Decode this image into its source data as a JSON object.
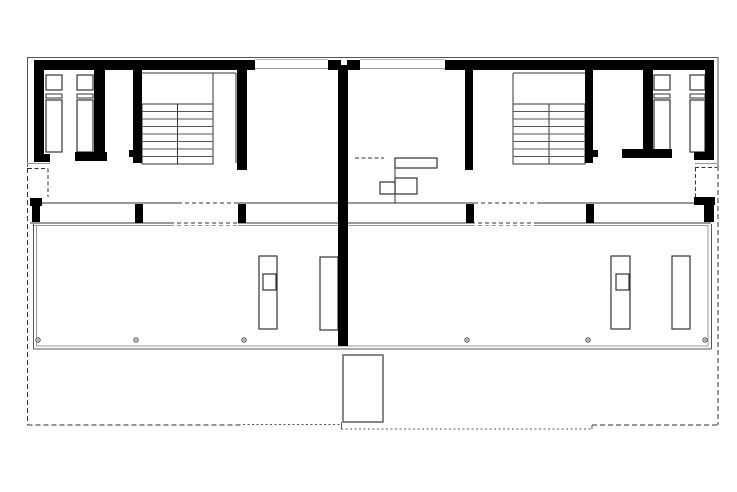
{
  "meta": {
    "viewbox": "0 0 737 492",
    "width": "737",
    "height": "492",
    "background": "#ffffff"
  },
  "colors": {
    "wall": "#000000",
    "dark": "#333333",
    "mid": "#555555",
    "soft": "#777777",
    "light": "#999999",
    "faint": "#bbbbbb",
    "white": "#ffffff"
  },
  "plan": {
    "walls": [
      {
        "x": 34,
        "y": 60,
        "w": 221,
        "h": 10,
        "name": "top-facade-left-segment"
      },
      {
        "x": 328,
        "y": 60,
        "w": 32,
        "h": 10,
        "name": "top-facade-center-pier"
      },
      {
        "x": 445,
        "y": 60,
        "w": 267,
        "h": 10,
        "name": "top-facade-right-segment"
      },
      {
        "x": 34,
        "y": 60,
        "w": 10,
        "h": 94,
        "name": "left-exterior-wall"
      },
      {
        "x": 34,
        "y": 154,
        "w": 16,
        "h": 8,
        "name": "left-exterior-wall-cap"
      },
      {
        "x": 94,
        "y": 68,
        "w": 11,
        "h": 84,
        "name": "left-bath-partition-wall"
      },
      {
        "x": 75,
        "y": 152,
        "w": 32,
        "h": 9,
        "name": "left-bath-partition-foot"
      },
      {
        "x": 133,
        "y": 68,
        "w": 9,
        "h": 95,
        "name": "left-stair-west-wall"
      },
      {
        "x": 129,
        "y": 150,
        "w": 5,
        "h": 7,
        "name": "left-stair-wall-stub"
      },
      {
        "x": 237,
        "y": 68,
        "w": 10,
        "h": 102,
        "name": "left-stair-east-wall"
      },
      {
        "x": 338,
        "y": 60,
        "w": 10,
        "h": 286,
        "name": "party-wall"
      },
      {
        "x": 465,
        "y": 68,
        "w": 8,
        "h": 102,
        "name": "right-stair-west-wall"
      },
      {
        "x": 585,
        "y": 68,
        "w": 8,
        "h": 95,
        "name": "right-stair-east-wall"
      },
      {
        "x": 593,
        "y": 150,
        "w": 5,
        "h": 7,
        "name": "right-stair-wall-stub"
      },
      {
        "x": 643,
        "y": 68,
        "w": 10,
        "h": 82,
        "name": "right-bath-partition-wall"
      },
      {
        "x": 622,
        "y": 149,
        "w": 50,
        "h": 9,
        "name": "right-bath-partition-foot"
      },
      {
        "x": 705,
        "y": 60,
        "w": 9,
        "h": 94,
        "name": "right-exterior-wall"
      },
      {
        "x": 694,
        "y": 152,
        "w": 20,
        "h": 8,
        "name": "right-exterior-wall-cap"
      },
      {
        "x": 30,
        "y": 198,
        "w": 12,
        "h": 8,
        "name": "left-entry-corner-cap"
      },
      {
        "x": 32,
        "y": 206,
        "w": 8,
        "h": 16,
        "name": "left-facade-pier"
      },
      {
        "x": 135,
        "y": 204,
        "w": 8,
        "h": 19,
        "name": "left-facade-mullion-1"
      },
      {
        "x": 238,
        "y": 204,
        "w": 8,
        "h": 19,
        "name": "left-facade-mullion-2"
      },
      {
        "x": 466,
        "y": 204,
        "w": 8,
        "h": 19,
        "name": "right-facade-mullion-1"
      },
      {
        "x": 586,
        "y": 204,
        "w": 8,
        "h": 19,
        "name": "right-facade-mullion-2"
      },
      {
        "x": 694,
        "y": 197,
        "w": 21,
        "h": 8,
        "name": "right-entry-corner-cap"
      },
      {
        "x": 704,
        "y": 205,
        "w": 10,
        "h": 17,
        "name": "right-facade-pier"
      }
    ],
    "white_rects": [
      {
        "x": 341,
        "y": 60,
        "w": 6,
        "h": 5,
        "name": "party-wall-top-notch"
      }
    ],
    "outline_rects": [
      {
        "x": 46,
        "y": 75,
        "w": 16,
        "h": 15,
        "c": "dark",
        "sw": 1.2,
        "name": "left-bath1-fixture-upper"
      },
      {
        "x": 46,
        "y": 94,
        "w": 16,
        "h": 4,
        "c": "dark",
        "sw": 1,
        "name": "left-bath1-fixture-divider"
      },
      {
        "x": 46,
        "y": 100,
        "w": 16,
        "h": 52,
        "c": "dark",
        "sw": 1.2,
        "name": "left-bath1-fixture-lower"
      },
      {
        "x": 77,
        "y": 75,
        "w": 16,
        "h": 15,
        "c": "dark",
        "sw": 1.2,
        "name": "left-bath2-fixture-upper"
      },
      {
        "x": 77,
        "y": 94,
        "w": 16,
        "h": 4,
        "c": "dark",
        "sw": 1,
        "name": "left-bath2-fixture-divider"
      },
      {
        "x": 77,
        "y": 100,
        "w": 16,
        "h": 52,
        "c": "dark",
        "sw": 1.2,
        "name": "left-bath2-fixture-lower"
      },
      {
        "x": 654,
        "y": 75,
        "w": 16,
        "h": 15,
        "c": "dark",
        "sw": 1.2,
        "name": "right-bath1-fixture-upper"
      },
      {
        "x": 654,
        "y": 94,
        "w": 16,
        "h": 4,
        "c": "dark",
        "sw": 1,
        "name": "right-bath1-fixture-divider"
      },
      {
        "x": 654,
        "y": 100,
        "w": 16,
        "h": 52,
        "c": "dark",
        "sw": 1.2,
        "name": "right-bath1-fixture-lower"
      },
      {
        "x": 690,
        "y": 75,
        "w": 15,
        "h": 15,
        "c": "dark",
        "sw": 1.2,
        "name": "right-bath2-fixture-upper"
      },
      {
        "x": 690,
        "y": 94,
        "w": 15,
        "h": 4,
        "c": "dark",
        "sw": 1,
        "name": "right-bath2-fixture-divider"
      },
      {
        "x": 690,
        "y": 100,
        "w": 15,
        "h": 52,
        "c": "dark",
        "sw": 1.2,
        "name": "right-bath2-fixture-lower"
      },
      {
        "x": 395,
        "y": 158,
        "w": 42,
        "h": 10,
        "c": "dark",
        "sw": 1.2,
        "name": "kitchen-counter-top-bar"
      },
      {
        "x": 395,
        "y": 178,
        "w": 22,
        "h": 16,
        "c": "dark",
        "sw": 1.2,
        "name": "kitchen-counter-mid-bar"
      },
      {
        "x": 380,
        "y": 182,
        "w": 15,
        "h": 12,
        "c": "dark",
        "sw": 1.2,
        "name": "kitchen-sink-box"
      },
      {
        "x": 259,
        "y": 256,
        "w": 18,
        "h": 73,
        "c": "dark",
        "sw": 1.2,
        "name": "left-terrace-island"
      },
      {
        "x": 263,
        "y": 274,
        "w": 13,
        "h": 16,
        "c": "dark",
        "sw": 1.2,
        "name": "left-terrace-island-sink"
      },
      {
        "x": 320,
        "y": 257,
        "w": 18,
        "h": 73,
        "c": "dark",
        "sw": 1.2,
        "name": "left-terrace-bench"
      },
      {
        "x": 611,
        "y": 256,
        "w": 19,
        "h": 73,
        "c": "dark",
        "sw": 1.2,
        "name": "right-terrace-island"
      },
      {
        "x": 616,
        "y": 274,
        "w": 13,
        "h": 16,
        "c": "dark",
        "sw": 1.2,
        "name": "right-terrace-island-sink"
      },
      {
        "x": 672,
        "y": 256,
        "w": 18,
        "h": 73,
        "c": "dark",
        "sw": 1.2,
        "name": "right-terrace-bench"
      },
      {
        "x": 343,
        "y": 355,
        "w": 40,
        "h": 67,
        "c": "mid",
        "sw": 1.4,
        "name": "garden-box"
      }
    ],
    "lines": [
      {
        "x1": 27,
        "y1": 57.5,
        "x2": 718,
        "y2": 57.5,
        "c": "mid",
        "w": 1,
        "name": "top-outer-face-line"
      },
      {
        "x1": 255,
        "y1": 59.5,
        "x2": 328,
        "y2": 59.5,
        "c": "faint",
        "w": 1,
        "name": "top-glazing-left-outer"
      },
      {
        "x1": 255,
        "y1": 68.5,
        "x2": 328,
        "y2": 68.5,
        "c": "light",
        "w": 1,
        "name": "top-glazing-left-inner"
      },
      {
        "x1": 360,
        "y1": 59.5,
        "x2": 445,
        "y2": 59.5,
        "c": "faint",
        "w": 1,
        "name": "top-glazing-right-outer"
      },
      {
        "x1": 360,
        "y1": 68.5,
        "x2": 445,
        "y2": 68.5,
        "c": "light",
        "w": 1,
        "name": "top-glazing-right-inner"
      },
      {
        "x1": 27.5,
        "y1": 57,
        "x2": 27.5,
        "y2": 167,
        "c": "mid",
        "w": 1,
        "name": "left-outer-face-line"
      },
      {
        "x1": 718,
        "y1": 57,
        "x2": 718,
        "y2": 166,
        "c": "mid",
        "w": 1,
        "name": "right-outer-face-line"
      },
      {
        "x1": 27,
        "y1": 163.5,
        "x2": 50,
        "y2": 163.5,
        "c": "light",
        "w": 1,
        "name": "left-entry-threshold"
      },
      {
        "x1": 695,
        "y1": 163.5,
        "x2": 718,
        "y2": 163.5,
        "c": "light",
        "w": 1,
        "name": "right-entry-threshold"
      },
      {
        "x1": 42,
        "y1": 203,
        "x2": 178,
        "y2": 203,
        "c": "dark",
        "w": 1,
        "name": "south-facade-top-a"
      },
      {
        "x1": 238,
        "y1": 203,
        "x2": 338,
        "y2": 203,
        "c": "dark",
        "w": 1,
        "name": "south-facade-top-b"
      },
      {
        "x1": 348,
        "y1": 203,
        "x2": 474,
        "y2": 203,
        "c": "dark",
        "w": 1,
        "name": "south-facade-top-c"
      },
      {
        "x1": 538,
        "y1": 203,
        "x2": 694,
        "y2": 203,
        "c": "dark",
        "w": 1,
        "name": "south-facade-top-d"
      },
      {
        "x1": 30,
        "y1": 223,
        "x2": 170,
        "y2": 223,
        "c": "dark",
        "w": 1,
        "name": "south-facade-bottom-a"
      },
      {
        "x1": 238,
        "y1": 223,
        "x2": 471,
        "y2": 223,
        "c": "dark",
        "w": 1,
        "name": "south-facade-bottom-b"
      },
      {
        "x1": 536,
        "y1": 223,
        "x2": 711,
        "y2": 223,
        "c": "dark",
        "w": 1,
        "name": "south-facade-bottom-c"
      },
      {
        "x1": 34,
        "y1": 225.5,
        "x2": 170,
        "y2": 225.5,
        "c": "light",
        "w": 1,
        "name": "terrace-top-inner-a"
      },
      {
        "x1": 238,
        "y1": 225.5,
        "x2": 471,
        "y2": 225.5,
        "c": "light",
        "w": 1,
        "name": "terrace-top-inner-b"
      },
      {
        "x1": 536,
        "y1": 225.5,
        "x2": 708,
        "y2": 225.5,
        "c": "light",
        "w": 1,
        "name": "terrace-top-inner-c"
      },
      {
        "x1": 142,
        "y1": 73,
        "x2": 236,
        "y2": 73,
        "c": "dark",
        "w": 1,
        "name": "left-stairwell-head-line"
      },
      {
        "x1": 236,
        "y1": 73,
        "x2": 236,
        "y2": 163,
        "c": "dark",
        "w": 1,
        "name": "left-stairwell-east-face"
      },
      {
        "x1": 213,
        "y1": 73,
        "x2": 213,
        "y2": 104,
        "c": "dark",
        "w": 1,
        "name": "left-stair-flight-edge"
      },
      {
        "x1": 513,
        "y1": 73,
        "x2": 585,
        "y2": 73,
        "c": "dark",
        "w": 1,
        "name": "right-stairwell-head-line"
      },
      {
        "x1": 513,
        "y1": 73,
        "x2": 513,
        "y2": 164,
        "c": "dark",
        "w": 1,
        "name": "right-stairwell-west-face"
      },
      {
        "x1": 395,
        "y1": 158,
        "x2": 395,
        "y2": 203,
        "c": "dark",
        "w": 1.2,
        "name": "kitchen-counter-stem"
      },
      {
        "x1": 33.5,
        "y1": 224,
        "x2": 33.5,
        "y2": 349,
        "c": "mid",
        "w": 1.2,
        "name": "terrace-west-edge-outer"
      },
      {
        "x1": 36.5,
        "y1": 225,
        "x2": 36.5,
        "y2": 346,
        "c": "light",
        "w": 1,
        "name": "terrace-west-edge-inner"
      },
      {
        "x1": 33.5,
        "y1": 349,
        "x2": 711.5,
        "y2": 349,
        "c": "mid",
        "w": 1.2,
        "name": "terrace-south-edge-outer"
      },
      {
        "x1": 36.5,
        "y1": 346,
        "x2": 708,
        "y2": 346,
        "c": "light",
        "w": 1,
        "name": "terrace-south-edge-inner"
      },
      {
        "x1": 711.5,
        "y1": 224,
        "x2": 711.5,
        "y2": 349,
        "c": "mid",
        "w": 1.2,
        "name": "terrace-east-edge-outer"
      },
      {
        "x1": 708,
        "y1": 225,
        "x2": 708,
        "y2": 346,
        "c": "light",
        "w": 1,
        "name": "terrace-east-edge-inner"
      },
      {
        "x1": 341.5,
        "y1": 422,
        "x2": 341.5,
        "y2": 429,
        "c": "mid",
        "w": 1,
        "name": "boundary-jog-west"
      },
      {
        "x1": 592,
        "y1": 425,
        "x2": 592,
        "y2": 429,
        "c": "mid",
        "w": 1,
        "name": "boundary-jog-east"
      }
    ],
    "dashed_lines": [
      {
        "x1": 27.5,
        "y1": 168,
        "x2": 27.5,
        "y2": 425,
        "d": "5 3",
        "c": "dark",
        "w": 1,
        "name": "west-property-boundary"
      },
      {
        "x1": 27.5,
        "y1": 425,
        "x2": 243,
        "y2": 425,
        "d": "5 3",
        "c": "dark",
        "w": 1,
        "name": "south-property-boundary-west"
      },
      {
        "x1": 243,
        "y1": 424.5,
        "x2": 341,
        "y2": 424.5,
        "d": "2 2.5",
        "c": "mid",
        "w": 1,
        "name": "south-property-boundary-dotted"
      },
      {
        "x1": 341,
        "y1": 429,
        "x2": 592,
        "y2": 429,
        "d": "2 2.5",
        "c": "mid",
        "w": 1,
        "name": "south-property-boundary-center"
      },
      {
        "x1": 592,
        "y1": 425,
        "x2": 718,
        "y2": 425,
        "d": "5 3",
        "c": "dark",
        "w": 1,
        "name": "south-property-boundary-east"
      },
      {
        "x1": 718,
        "y1": 166,
        "x2": 718,
        "y2": 425,
        "d": "5 3",
        "c": "dark",
        "w": 1,
        "name": "east-property-boundary"
      },
      {
        "x1": 28,
        "y1": 168.5,
        "x2": 48,
        "y2": 168.5,
        "d": "4 2.5",
        "c": "dark",
        "w": 1,
        "name": "left-entry-recess-top"
      },
      {
        "x1": 48,
        "y1": 168.5,
        "x2": 48,
        "y2": 197,
        "d": "4 2.5",
        "c": "dark",
        "w": 1,
        "name": "left-entry-recess-side"
      },
      {
        "x1": 695,
        "y1": 167.5,
        "x2": 717,
        "y2": 167.5,
        "d": "4 2.5",
        "c": "dark",
        "w": 1,
        "name": "right-entry-recess-top"
      },
      {
        "x1": 695.5,
        "y1": 167.5,
        "x2": 695.5,
        "y2": 198,
        "d": "4 2.5",
        "c": "dark",
        "w": 1,
        "name": "right-entry-recess-side"
      },
      {
        "x1": 355,
        "y1": 158,
        "x2": 384,
        "y2": 158,
        "d": "4 2.5",
        "c": "dark",
        "w": 1.2,
        "name": "kitchen-reference-dash"
      },
      {
        "x1": 178,
        "y1": 203,
        "x2": 238,
        "y2": 203,
        "d": "4 3",
        "c": "dark",
        "w": 1,
        "name": "left-sliding-opening-top"
      },
      {
        "x1": 170,
        "y1": 223,
        "x2": 238,
        "y2": 223,
        "d": "4 3",
        "c": "dark",
        "w": 1.2,
        "name": "left-sliding-opening-bottom"
      },
      {
        "x1": 170,
        "y1": 225.5,
        "x2": 238,
        "y2": 225.5,
        "d": "4 3",
        "c": "light",
        "w": 1,
        "name": "left-sliding-opening-inner"
      },
      {
        "x1": 474,
        "y1": 203,
        "x2": 538,
        "y2": 203,
        "d": "4 3",
        "c": "dark",
        "w": 1,
        "name": "right-sliding-opening-top"
      },
      {
        "x1": 471,
        "y1": 223,
        "x2": 536,
        "y2": 223,
        "d": "4 3",
        "c": "dark",
        "w": 1.2,
        "name": "right-sliding-opening-bottom"
      },
      {
        "x1": 471,
        "y1": 225.5,
        "x2": 536,
        "y2": 225.5,
        "d": "4 3",
        "c": "light",
        "w": 1,
        "name": "right-sliding-opening-inner"
      }
    ],
    "stairs": [
      {
        "x": 142,
        "y": 104,
        "w": 71,
        "h": 60,
        "divider_x": 177.5,
        "rows": 8,
        "name": "left-stair"
      },
      {
        "x": 513,
        "y": 104,
        "w": 72,
        "h": 60,
        "divider_x": 549,
        "rows": 8,
        "name": "right-stair"
      }
    ],
    "dots": {
      "y": 340,
      "r": 2.2,
      "inner_r": 0.7,
      "xs": [
        38,
        136,
        244,
        467,
        588,
        705
      ],
      "name": "terrace-column-dot"
    }
  }
}
